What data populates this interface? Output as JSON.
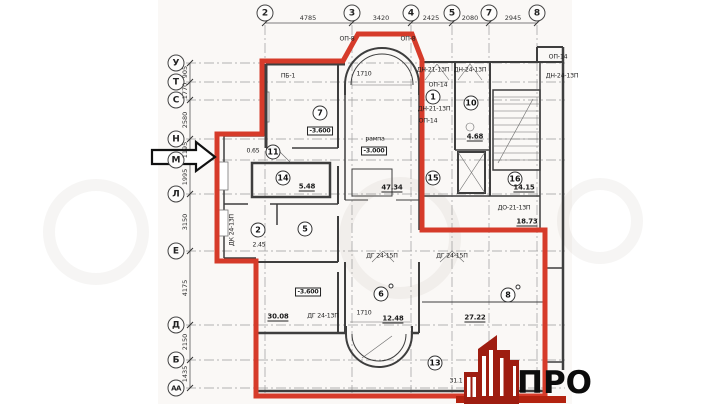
{
  "colors": {
    "outline_red": "#d63b2a",
    "logo_red": "#9e1d11",
    "logo_bar_red": "#b3220f",
    "wall_gray": "#3e3e3e"
  },
  "axes": {
    "top": [
      {
        "label": "2",
        "x": 265
      },
      {
        "label": "3",
        "x": 352
      },
      {
        "label": "4",
        "x": 411
      },
      {
        "label": "5",
        "x": 452
      },
      {
        "label": "7",
        "x": 489
      },
      {
        "label": "8",
        "x": 537
      }
    ],
    "top_dims": [
      {
        "text": "4785",
        "x": 308
      },
      {
        "text": "3420",
        "x": 381
      },
      {
        "text": "2425",
        "x": 431
      },
      {
        "text": "2080",
        "x": 470
      },
      {
        "text": "2945",
        "x": 513
      }
    ],
    "left": [
      {
        "label": "У",
        "y": 63
      },
      {
        "label": "Т",
        "y": 82
      },
      {
        "label": "С",
        "y": 100
      },
      {
        "label": "Н",
        "y": 139
      },
      {
        "label": "М",
        "y": 160
      },
      {
        "label": "Л",
        "y": 194
      },
      {
        "label": "Е",
        "y": 251
      },
      {
        "label": "Д",
        "y": 325
      },
      {
        "label": "Б",
        "y": 360
      },
      {
        "label": "АА",
        "y": 388
      }
    ],
    "left_dims": [
      {
        "text": "905",
        "y": 72
      },
      {
        "text": "1770",
        "y": 91
      },
      {
        "text": "2580",
        "y": 120
      },
      {
        "text": "1195",
        "y": 150
      },
      {
        "text": "1995",
        "y": 177
      },
      {
        "text": "3150",
        "y": 222
      },
      {
        "text": "4175",
        "y": 288
      },
      {
        "text": "2150",
        "y": 342
      },
      {
        "text": "1435",
        "y": 374
      }
    ]
  },
  "rooms": [
    {
      "num": "7",
      "x": 320,
      "y": 113
    },
    {
      "num": "11",
      "x": 273,
      "y": 152
    },
    {
      "num": "14",
      "x": 283,
      "y": 178
    },
    {
      "num": "2",
      "x": 258,
      "y": 230
    },
    {
      "num": "5",
      "x": 305,
      "y": 229
    },
    {
      "num": "6",
      "x": 381,
      "y": 294,
      "sup": true
    },
    {
      "num": "13",
      "x": 435,
      "y": 363
    },
    {
      "num": "8",
      "x": 508,
      "y": 295,
      "sup": true
    },
    {
      "num": "1",
      "x": 433,
      "y": 97
    },
    {
      "num": "10",
      "x": 471,
      "y": 103
    },
    {
      "num": "15",
      "x": 433,
      "y": 178
    },
    {
      "num": "16",
      "x": 515,
      "y": 179
    }
  ],
  "labels": [
    {
      "text": "-3.600",
      "x": 320,
      "y": 131,
      "style": "boxed"
    },
    {
      "text": "-3.600",
      "x": 308,
      "y": 292,
      "style": "boxed"
    },
    {
      "text": "рампа",
      "x": 375,
      "y": 139
    },
    {
      "text": "-3.000",
      "x": 374,
      "y": 151,
      "style": "boxed"
    },
    {
      "text": "47.34",
      "x": 392,
      "y": 188,
      "style": "area"
    },
    {
      "text": "0.65",
      "x": 253,
      "y": 151
    },
    {
      "text": "5.48",
      "x": 307,
      "y": 187,
      "style": "area"
    },
    {
      "text": "2.45",
      "x": 259,
      "y": 245
    },
    {
      "text": "30.08",
      "x": 278,
      "y": 317,
      "style": "area"
    },
    {
      "text": "12.48",
      "x": 393,
      "y": 319,
      "style": "area"
    },
    {
      "text": "1710",
      "x": 364,
      "y": 313
    },
    {
      "text": "1710",
      "x": 364,
      "y": 74
    },
    {
      "text": "27.22",
      "x": 475,
      "y": 318,
      "style": "area"
    },
    {
      "text": "31.1",
      "x": 456,
      "y": 381
    },
    {
      "text": "18.73",
      "x": 527,
      "y": 222,
      "style": "area"
    },
    {
      "text": "14.15",
      "x": 524,
      "y": 188,
      "style": "area"
    },
    {
      "text": "4.68",
      "x": 475,
      "y": 137,
      "style": "area"
    },
    {
      "text": "ДН-21-13П",
      "x": 433,
      "y": 70
    },
    {
      "text": "ДН-24-13П",
      "x": 470,
      "y": 70
    },
    {
      "text": "ОП-14",
      "x": 438,
      "y": 85
    },
    {
      "text": "ДН-21-13П",
      "x": 434,
      "y": 109
    },
    {
      "text": "ОП-14",
      "x": 428,
      "y": 121
    },
    {
      "text": "ОП-14",
      "x": 558,
      "y": 57
    },
    {
      "text": "ДН-24-13П",
      "x": 562,
      "y": 76
    },
    {
      "text": "ДО-21-13П",
      "x": 514,
      "y": 208
    },
    {
      "text": "ДГ 24-15П",
      "x": 382,
      "y": 256
    },
    {
      "text": "ДГ 24-15П",
      "x": 452,
      "y": 256
    },
    {
      "text": "ДГ 24-13П",
      "x": 323,
      "y": 316
    },
    {
      "text": "ПБ-1",
      "x": 288,
      "y": 76
    },
    {
      "text": "ОП-8",
      "x": 347,
      "y": 39
    },
    {
      "text": "ОП-8",
      "x": 408,
      "y": 39
    },
    {
      "text": "ДК 24-13П",
      "x": 232,
      "y": 230,
      "style": "rot"
    }
  ],
  "logo": {
    "text": "ПРО"
  }
}
